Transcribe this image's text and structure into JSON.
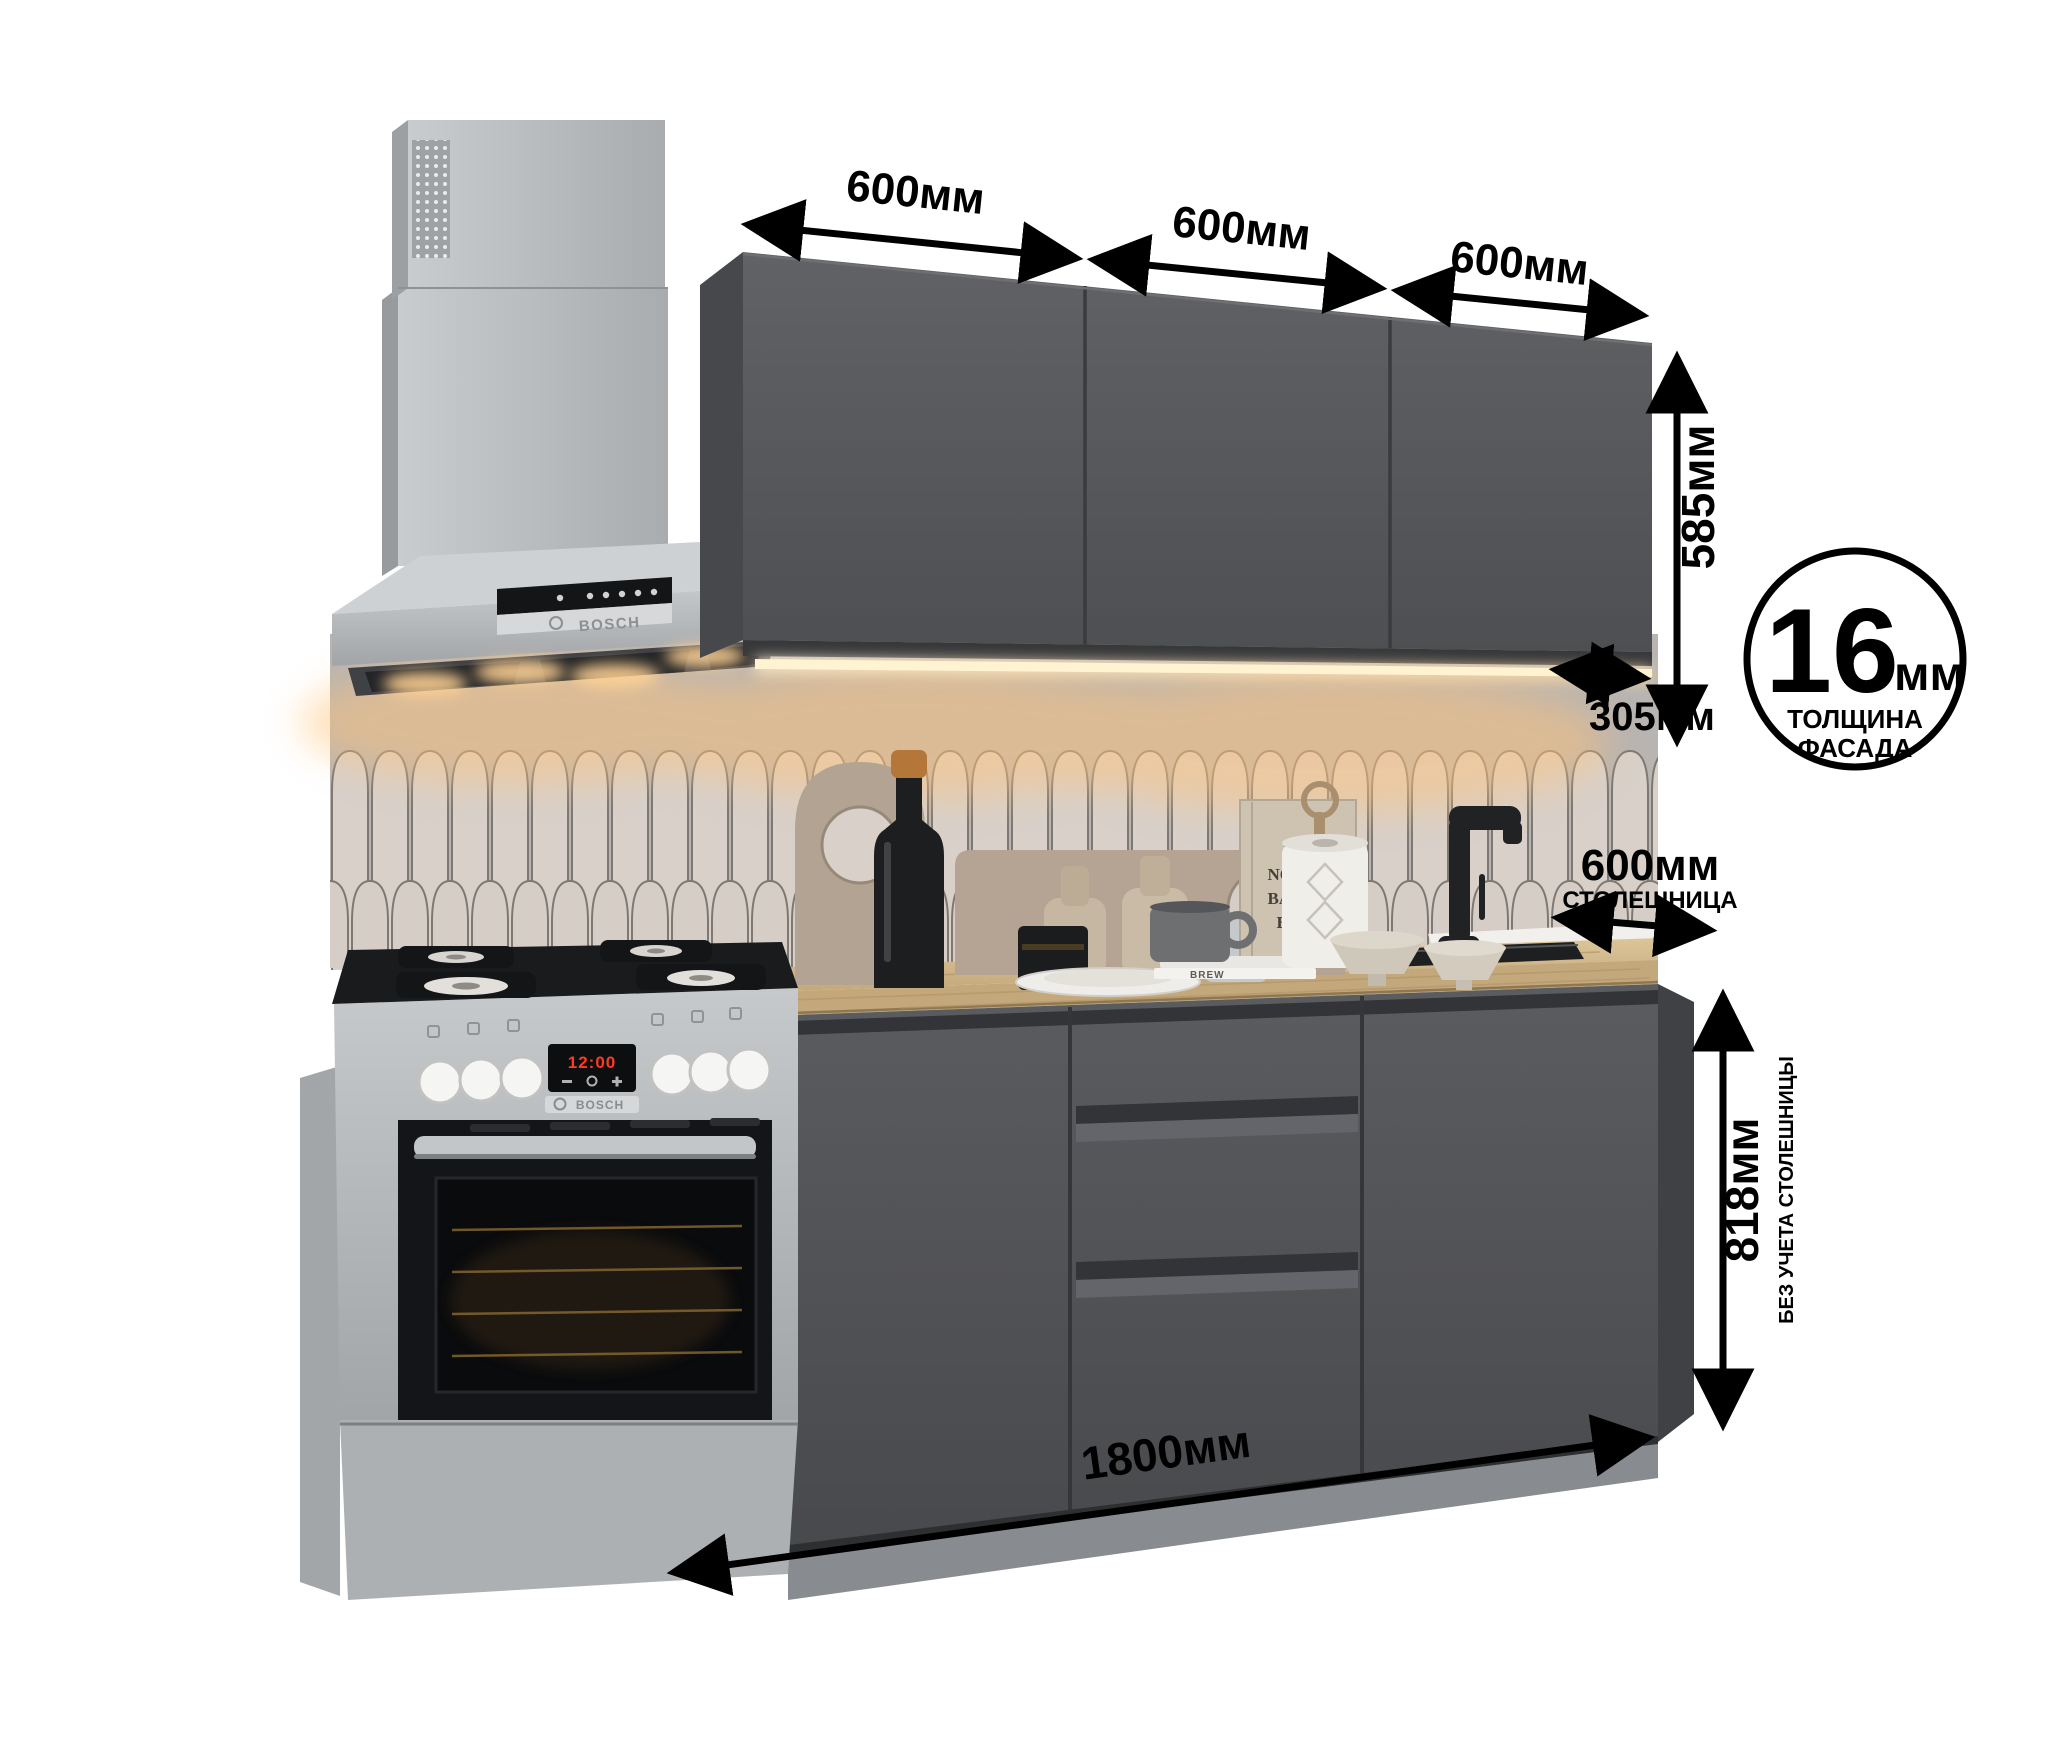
{
  "annotations": {
    "top_widths": [
      "600мм",
      "600мм",
      "600мм"
    ],
    "upper_height": "585мм",
    "upper_depth": "305мм",
    "facade_badge": {
      "value": "16",
      "unit": "мм",
      "caption_line1": "ТОЛЩИНА",
      "caption_line2": "ФАСАДА"
    },
    "countertop_depth": {
      "value": "600мм",
      "caption": "СТОЛЕШНИЦА"
    },
    "base_height": {
      "value": "818мм",
      "caption": "БЕЗ УЧЕТА СТОЛЕШНИЦЫ"
    },
    "total_width": "1800мм"
  },
  "appliances": {
    "hood": {
      "brand": "BOSCH"
    },
    "stove": {
      "brand": "BOSCH",
      "display_time": "12:00"
    }
  },
  "decor": {
    "book": {
      "line1": "THE",
      "line2": "NORDIC",
      "line3": "BAKING",
      "line4": "BOOK"
    },
    "small_book": "BREW"
  },
  "palette": {
    "facade_graphite": "#56575a",
    "countertop_oak": "#cdb389",
    "led_warm": "#ffd9a0",
    "tile_cream": "#d8d0c9",
    "appliance_silver": "#b6b9bb",
    "annotation_black": "#000000"
  }
}
